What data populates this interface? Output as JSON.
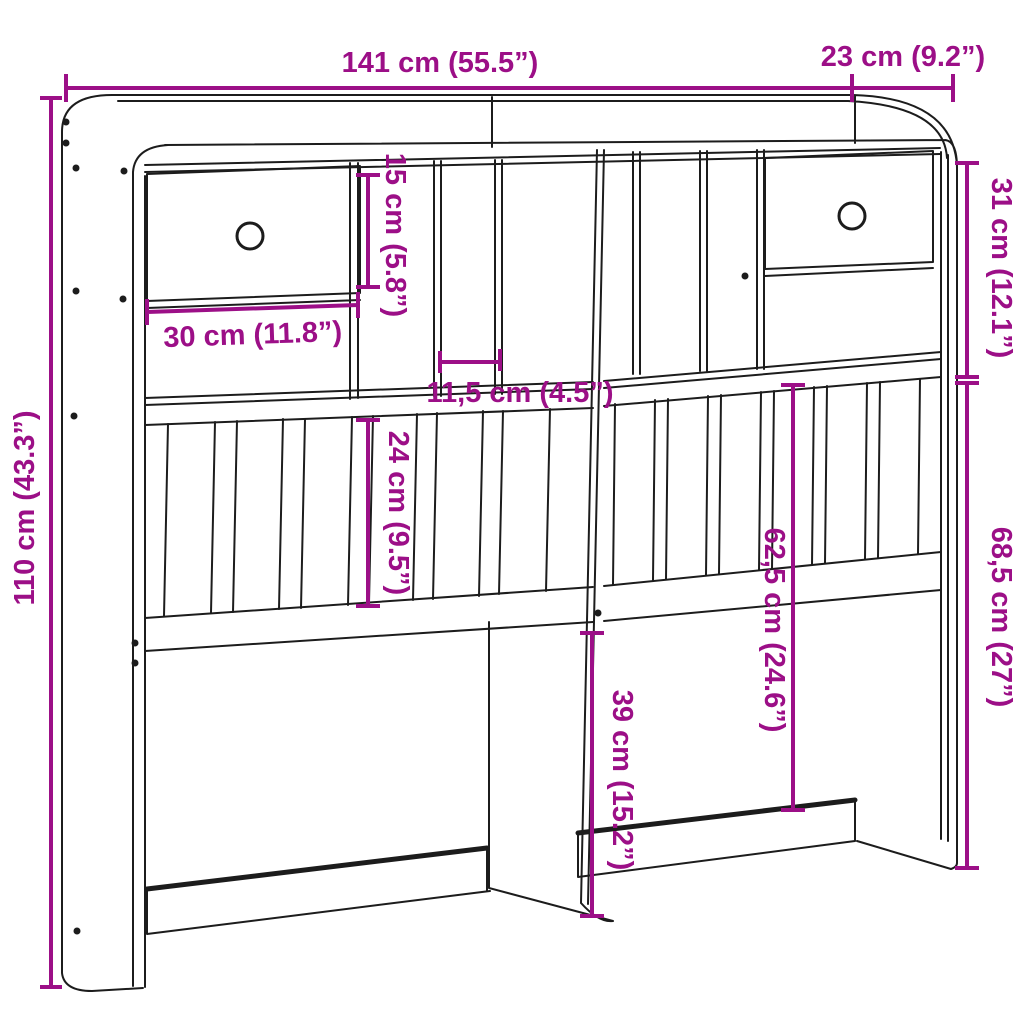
{
  "diagram": {
    "kind": "headboard-with-storage dimension drawing",
    "colors": {
      "accent": "#9c0f87",
      "line": "#1c1c1c",
      "background": "#ffffff"
    }
  },
  "dimensions": {
    "overall_width": "141 cm (55.5”)",
    "top_depth": "23 cm (9.2”)",
    "overall_height": "110 cm (43.3”)",
    "upper_cubby_height": "15 cm (5.8”)",
    "upper_section_height": "31 cm (12.1”)",
    "drawer_shelf_width": "30 cm (11.8”)",
    "cubby_spacing": "11,5 cm (4.5”)",
    "slat_panel_height": "24 cm (9.5”)",
    "right_opening_height": "62,5 cm (24.6”)",
    "lower_opening_height": "39 cm (15.2”)",
    "right_section_height": "68,5 cm (27”)"
  }
}
